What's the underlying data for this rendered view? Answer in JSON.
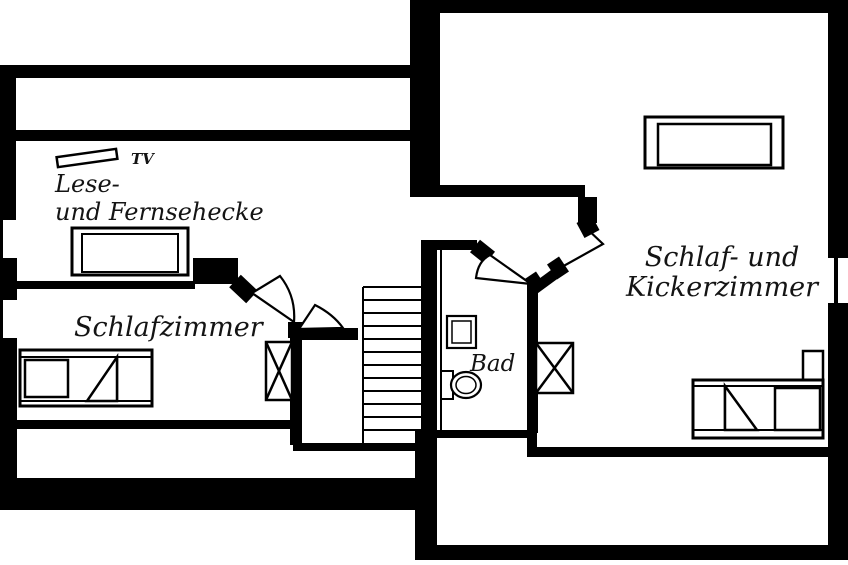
{
  "plan": {
    "background": "#ffffff",
    "wall_color": "#000000",
    "text_color": "#141414",
    "labels": {
      "tv": "TV",
      "lese_line1": "Lese-",
      "lese_line2": "und Fernsehecke",
      "schlafzimmer": "Schlafzimmer",
      "bad": "Bad",
      "kicker_line1": "Schlaf- und",
      "kicker_line2": "Kickerzimmer"
    }
  }
}
